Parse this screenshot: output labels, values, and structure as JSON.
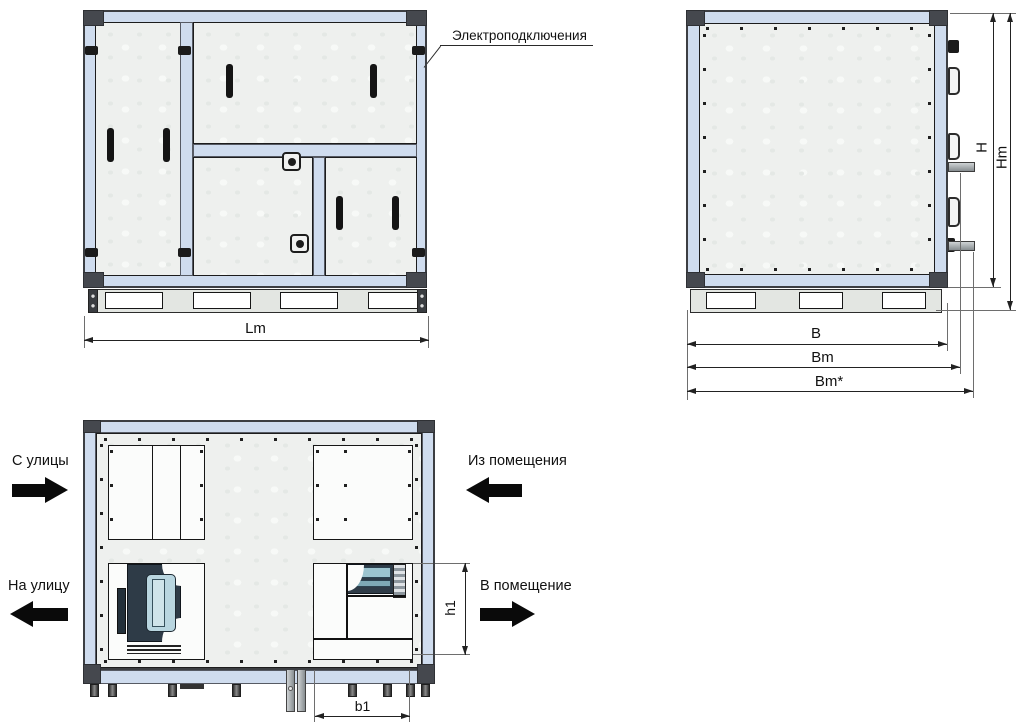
{
  "callouts": {
    "electrical": "Электроподключения"
  },
  "dimensions": {
    "lm": "Lm",
    "h": "H",
    "hm": "Hm",
    "b": "B",
    "bm": "Bm",
    "bm_star": "Bm*",
    "h1": "h1",
    "b1": "b1"
  },
  "airflow": {
    "from_street": "С улицы",
    "from_room": "Из помещения",
    "to_street": "На улицу",
    "to_room": "В помещение"
  },
  "colors": {
    "frame_blue": "#cfdcee",
    "corner_gray": "#45484e",
    "panel_gray": "#eef0ee",
    "line_black": "#1c1c1c",
    "fan_dark": "#2e3b47",
    "fan_light": "#b9d6e0",
    "arrow_black": "#0a0a0a"
  }
}
